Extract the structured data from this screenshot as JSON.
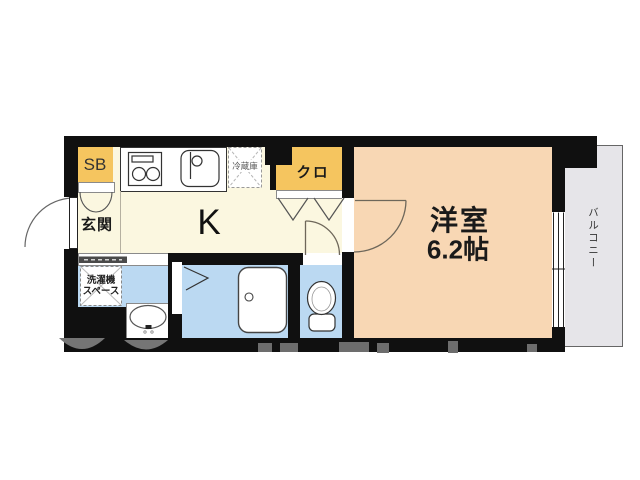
{
  "title": "1K apartment floor plan",
  "colors": {
    "wall": "#101010",
    "floor_cream": "#FBF7E0",
    "room_peach": "#F8D7B4",
    "storage_yellow": "#F5C55F",
    "wet_blue": "#BBD9F2",
    "balcony_gray": "#E6E5E9",
    "fixture_line": "#333333",
    "watermark_gray": "#757575"
  },
  "rooms": {
    "shoe_box": {
      "label": "SB"
    },
    "entrance": {
      "label": "玄関"
    },
    "kitchen": {
      "label": "K"
    },
    "refrigerator_space": {
      "label": "冷蔵庫"
    },
    "closet": {
      "label": "クロ"
    },
    "western_room": {
      "label": "洋室",
      "size": "6.2帖"
    },
    "balcony": {
      "label": "バルコニー"
    },
    "laundry_space": {
      "label_line1": "洗濯機",
      "label_line2": "スペース"
    }
  }
}
